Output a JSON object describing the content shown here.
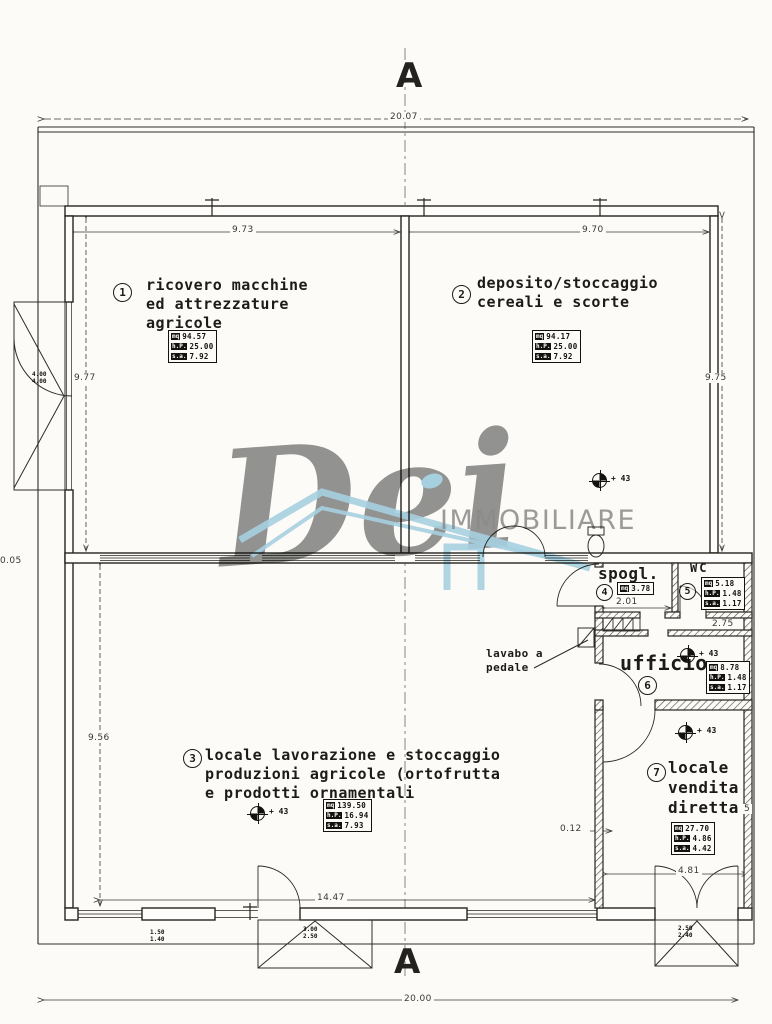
{
  "colors": {
    "paper": "#fcfbf8",
    "ink": "#26241f",
    "dim_ink": "#3a3833",
    "watermark_gray": "#8c8c8c",
    "watermark_blue": "#a8d4e7"
  },
  "section_markers": {
    "top": "A",
    "bottom": "A"
  },
  "watermark": {
    "script": "Dei",
    "caps": "IMMOBILIARE"
  },
  "annotations": {
    "lavabo_label": "lavabo a\npedale",
    "level_mark": "+ 43"
  },
  "dims": {
    "top_overall": "20.07",
    "bay_left": "9.73",
    "bay_right": "9.70",
    "left_upper": "9.77",
    "right_upper": "9.75",
    "left_partial": "0.05",
    "left_lower": "9.56",
    "spogl_width": "2.01",
    "wc_width": "2.75",
    "wall_offset": "0.12",
    "hall_width": "14.47",
    "shopfront_width": "4.81",
    "bottom_overall": "20.00",
    "right_partial": "5",
    "left_door_size": "4.00\n4.00",
    "window_left_size": "1.50\n1.40",
    "garage_center_size": "3.00\n2.50",
    "shop_door_size": "2.50\n2.40"
  },
  "rooms": {
    "r1": {
      "num": "1",
      "name": "ricovero macchine\ned attrezzature\nagricole",
      "mq_label": "mq",
      "mq": "94.57",
      "hp_label": "h.P.",
      "hp": "25.00",
      "sa_label": "s.a.",
      "sa": "7.92"
    },
    "r2": {
      "num": "2",
      "name": "deposito/stoccaggio\ncereali e scorte",
      "mq_label": "mq",
      "mq": "94.17",
      "hp_label": "h.P.",
      "hp": "25.00",
      "sa_label": "s.a.",
      "sa": "7.92"
    },
    "r3": {
      "num": "3",
      "name": "locale lavorazione e stoccaggio\nproduzioni agricole (ortofrutta\ne prodotti ornamentali",
      "mq_label": "mq",
      "mq": "139.50",
      "hp_label": "h.P.",
      "hp": "16.94",
      "sa_label": "s.a.",
      "sa": "7.93"
    },
    "r4": {
      "num": "4",
      "name": "spogl.",
      "mq_label": "mq",
      "mq": "3.78"
    },
    "r5": {
      "num": "5",
      "name": "WC",
      "mq_label": "mq",
      "mq": "5.18",
      "hp_label": "h.P.",
      "hp": "1.48",
      "sa_label": "s.a.",
      "sa": "1.17"
    },
    "r6": {
      "num": "6",
      "name": "ufficio",
      "mq_label": "mq",
      "mq": "8.78",
      "hp_label": "h.P.",
      "hp": "1.48",
      "sa_label": "s.a.",
      "sa": "1.17"
    },
    "r7": {
      "num": "7",
      "name": "locale\nvendita\ndiretta",
      "mq_label": "mq",
      "mq": "27.70",
      "hp_label": "h.P.",
      "hp": "4.86",
      "sa_label": "s.a.",
      "sa": "4.42"
    }
  }
}
